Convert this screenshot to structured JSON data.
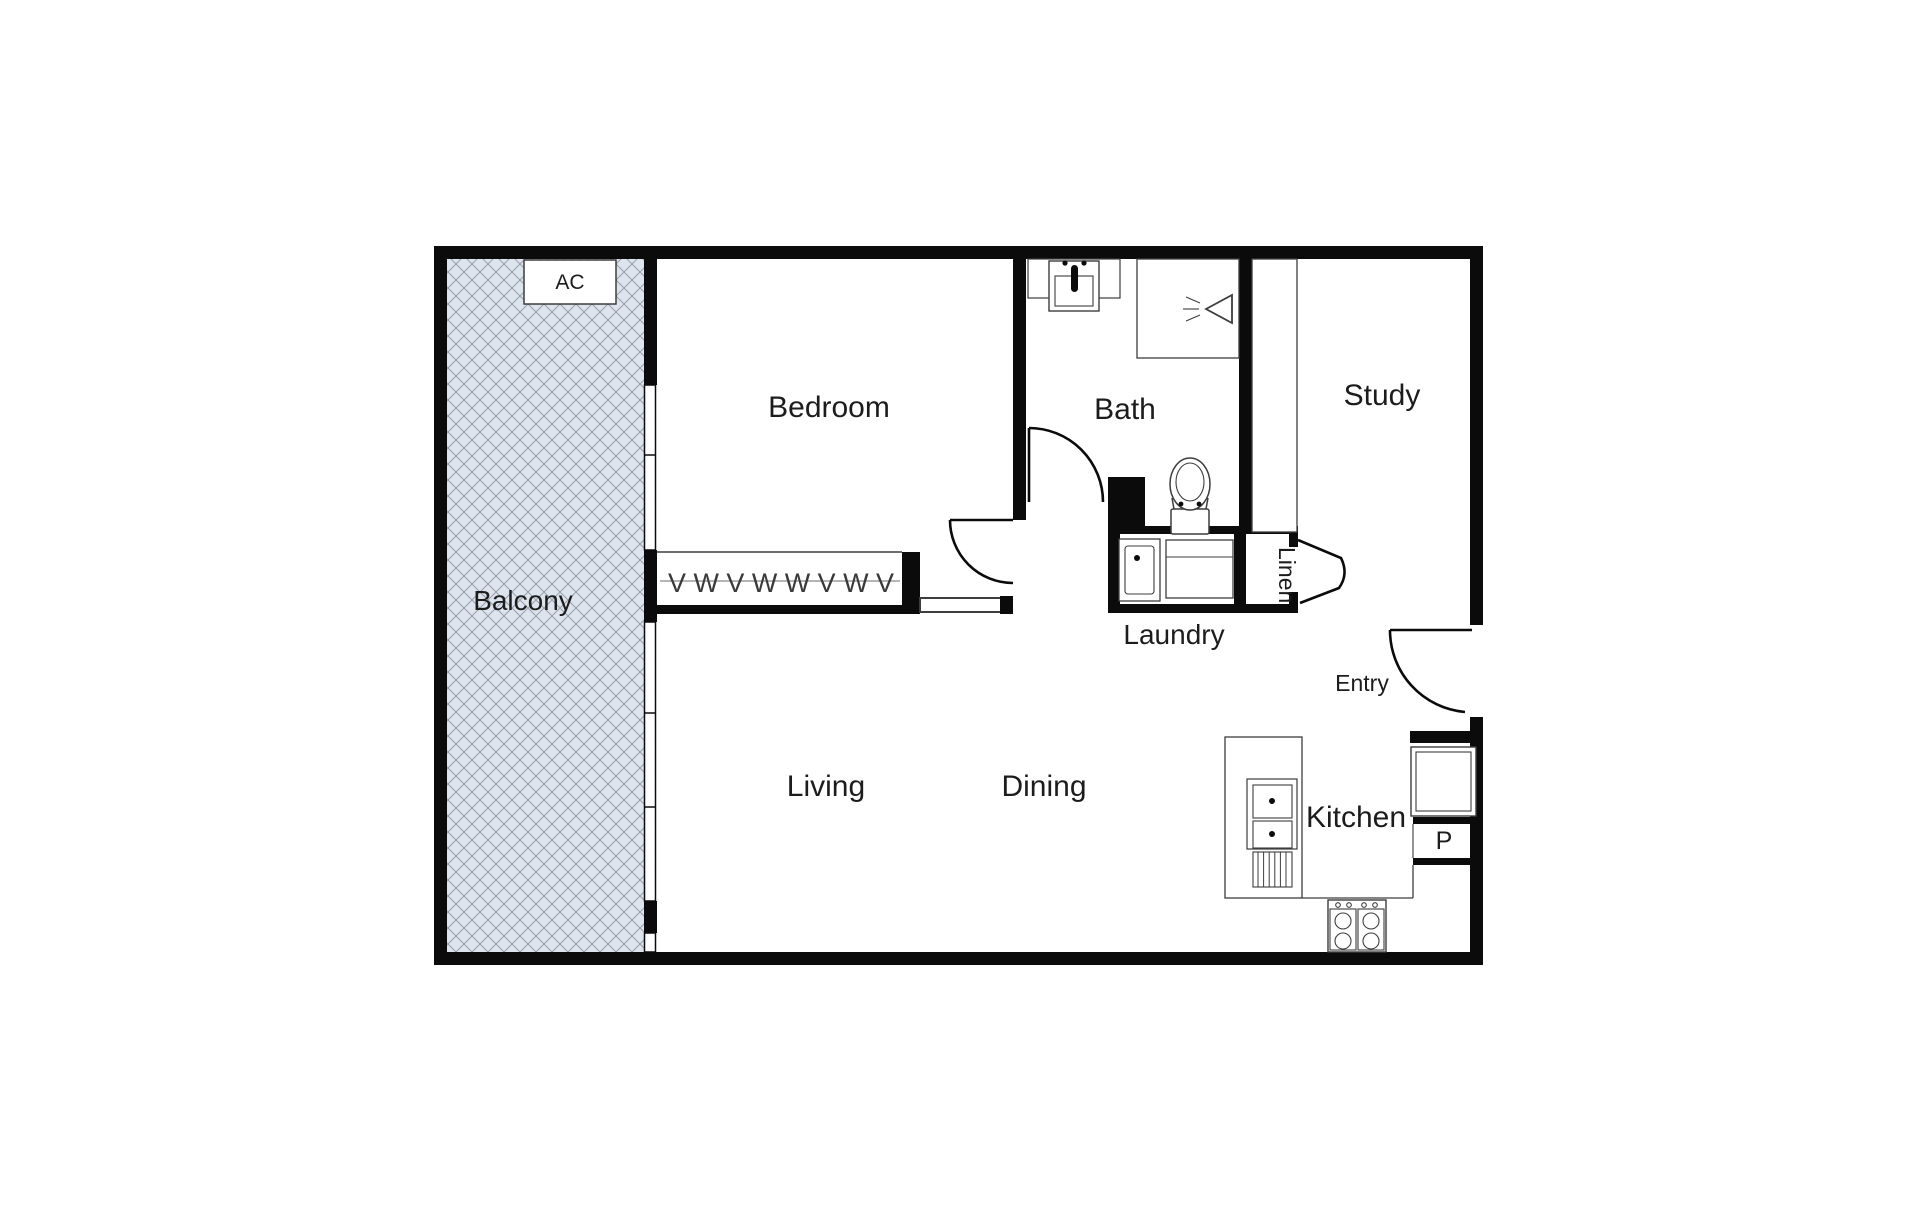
{
  "plan": {
    "colors": {
      "wall": "#0b0b0b",
      "line": "#3d3d3d",
      "text": "#1c1c1c",
      "hatch-bg": "#dee4ee",
      "hatch-line": "#9aa2ad"
    },
    "rooms": {
      "balcony": "Balcony",
      "bedroom": "Bedroom",
      "bath": "Bath",
      "study": "Study",
      "living": "Living",
      "dining": "Dining",
      "kitchen": "Kitchen",
      "laundry": "Laundry",
      "linen": "Linen",
      "entry": "Entry"
    },
    "labels": {
      "ac": "AC",
      "pantry": "P"
    },
    "symbols": {
      "wardrobe": "V W V W W V W V"
    }
  }
}
